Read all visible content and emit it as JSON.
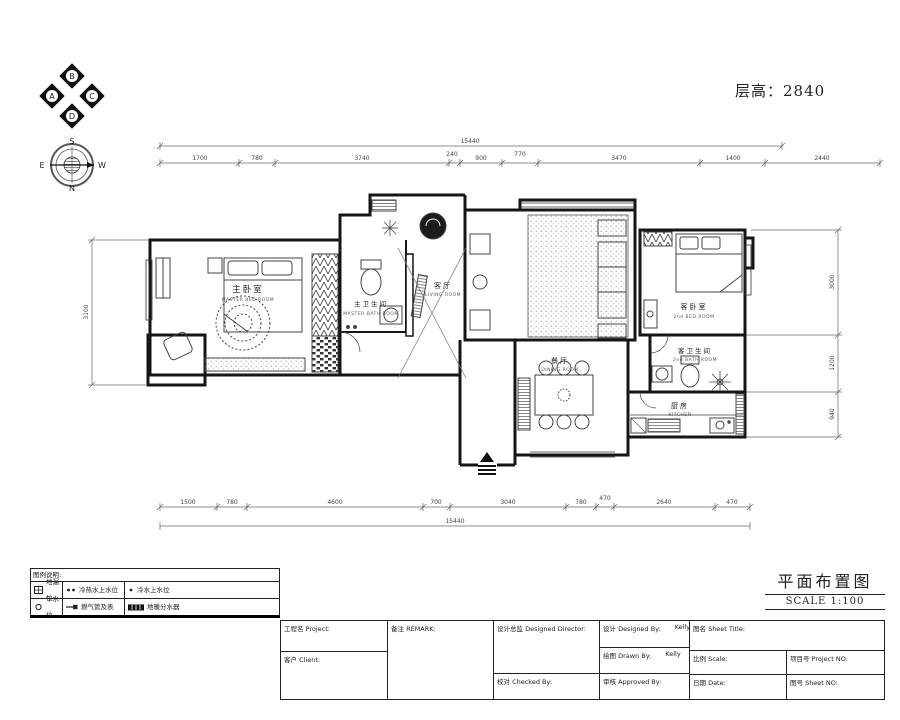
{
  "header": {
    "floor_height_label": "层高：2840"
  },
  "compass": {
    "abcd": [
      "B",
      "A",
      "C",
      "D"
    ],
    "rose": {
      "top": "S",
      "left": "E",
      "right": "W",
      "bottom": "N"
    }
  },
  "plan": {
    "rooms": [
      {
        "name": "主卧室",
        "sub": "MASTER BED ROOM"
      },
      {
        "name": "主卫生间",
        "sub": "MASTER BATH ROOM"
      },
      {
        "name": "客厅",
        "sub": "LIVING ROOM"
      },
      {
        "name": "餐厅",
        "sub": "DINING ROOM"
      },
      {
        "name": "客卧室",
        "sub": "2nd BED ROOM"
      },
      {
        "name": "客卫生间",
        "sub": "2nd BATH ROOM"
      },
      {
        "name": "厨房",
        "sub": "KITCHEN"
      }
    ],
    "dims": {
      "top_total": "15440",
      "top_segments": [
        "1700",
        "780",
        "3740",
        "240",
        "900",
        "770",
        "3470",
        "1400",
        "2440"
      ],
      "bottom_total": "15440",
      "bottom_segments": [
        "1500",
        "780",
        "4600",
        "700",
        "3040",
        "780",
        "470",
        "2640",
        "470"
      ],
      "left": [
        "3100"
      ],
      "right": [
        "3000",
        "1200",
        "940"
      ]
    }
  },
  "legend": {
    "header": "图例说明:",
    "items": [
      {
        "symbol": "floor-drain",
        "label": "地漏位"
      },
      {
        "symbol": "hot-cold-supply",
        "label": "冷热水上水位"
      },
      {
        "symbol": "cold-supply",
        "label": "冷水上水位"
      },
      {
        "symbol": "drain-outlet",
        "label": "下水位"
      },
      {
        "symbol": "gas-pipe-meter",
        "label": "燃气管及表"
      },
      {
        "symbol": "floor-heating",
        "label": "地暖分水器"
      }
    ]
  },
  "title_area": {
    "title": "平面布置图",
    "scale": "SCALE 1:100"
  },
  "title_block": {
    "project_label": "工程名 Project:",
    "client_label": "客户 Client:",
    "remark_label": "备注 REMARK:",
    "design_director_label": "设计总监 Designed Director:",
    "checked_label": "校对 Checked By:",
    "designed_label": "设计 Designed By:",
    "designed_value": "Kelly",
    "drawn_label": "绘图 Drawn By:",
    "drawn_value": "Kelly",
    "approved_label": "审核 Approved By:",
    "sheet_title_label": "图名 Sheet Title:",
    "scale_label": "比例 Scale:",
    "project_no_label": "项目号 Project NO:",
    "date_label": "日期 Date:",
    "sheet_no_label": "图号 Sheet NO:"
  }
}
